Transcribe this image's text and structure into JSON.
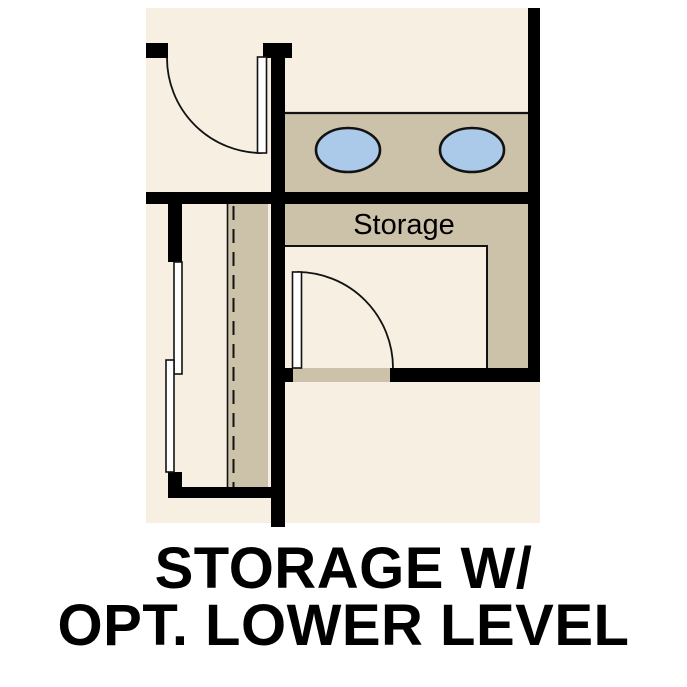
{
  "plan": {
    "room_label": "Storage",
    "caption_line1": "STORAGE W/",
    "caption_line2": "OPT. LOWER LEVEL"
  },
  "colors": {
    "floor_cream": "#f6efe2",
    "counter_tan": "#ccc1a9",
    "sink_blue": "#abcae9",
    "wall_black": "#000000",
    "line_black": "#121212",
    "door_white": "#ffffff",
    "page_white": "#ffffff",
    "text_black": "#000000"
  }
}
